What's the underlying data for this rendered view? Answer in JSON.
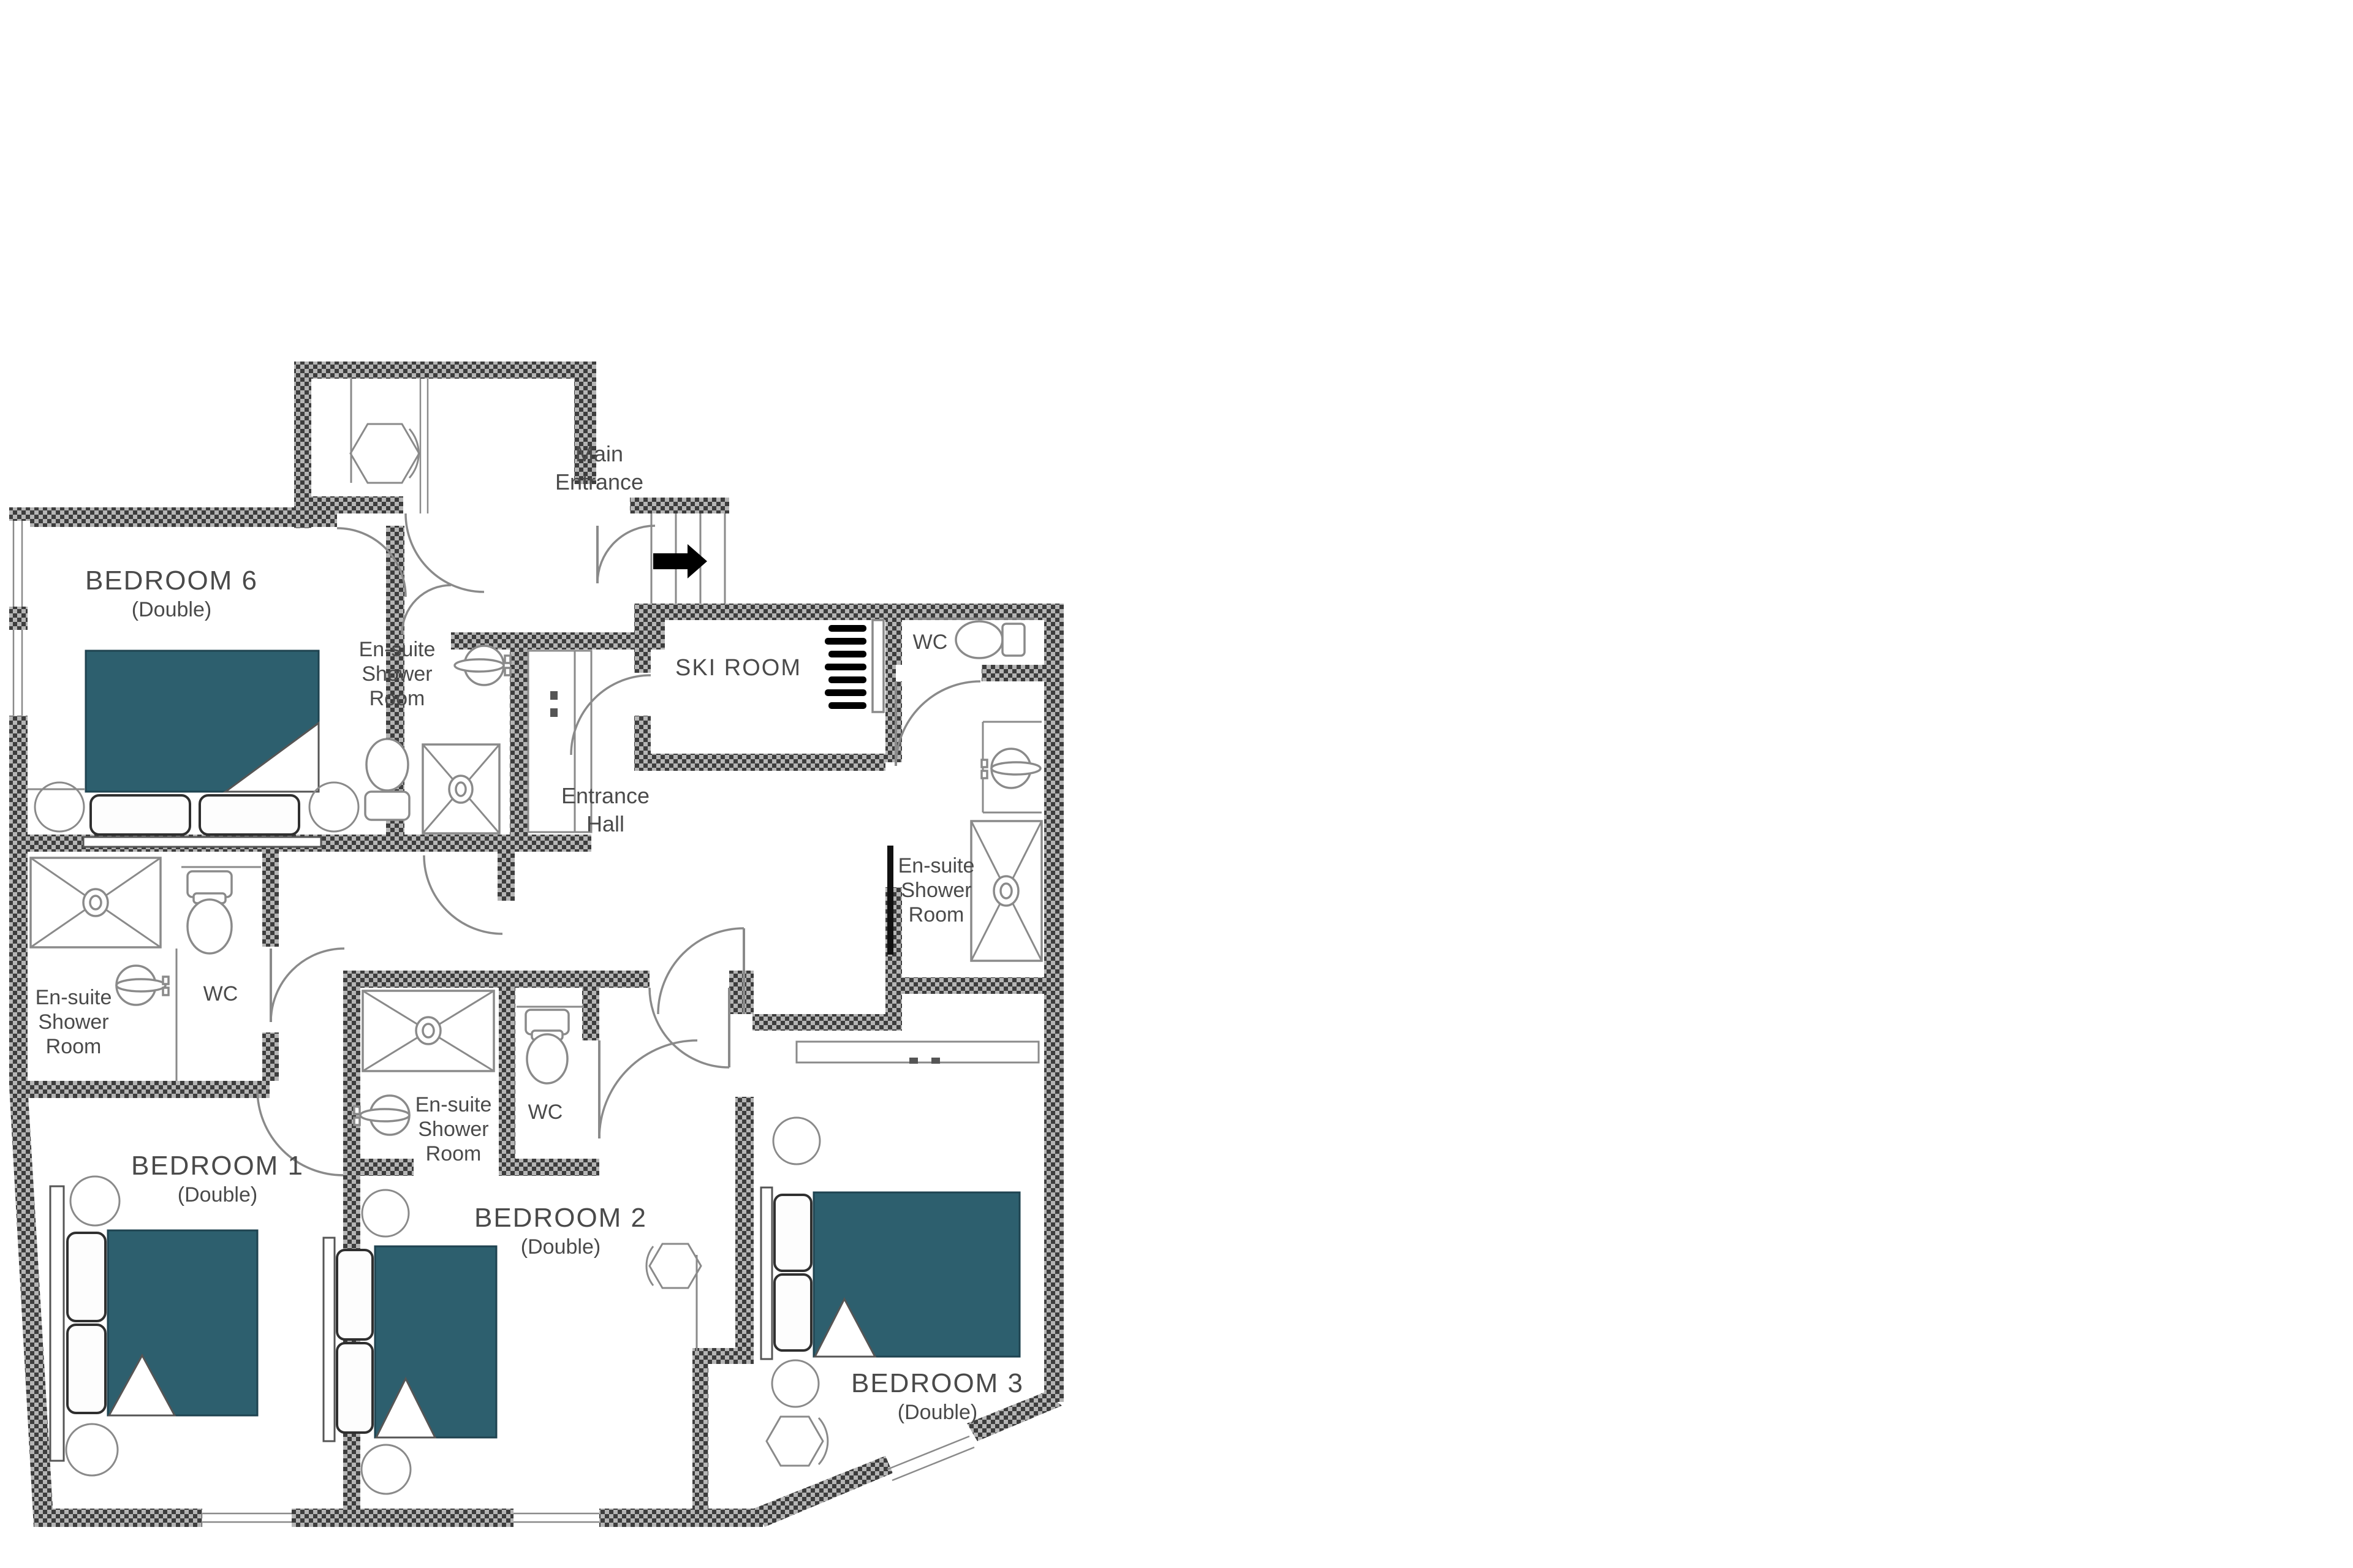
{
  "colors": {
    "bg": "#ffffff",
    "bed_fill": "#2d5f6e",
    "bed_edge": "#1f4350",
    "wall_dark": "#3d3d3d",
    "wall_light": "#b5b5b5",
    "line": "#8a8a8a",
    "dark_line": "#555555",
    "text": "#4a4a4a",
    "arrow": "#000000"
  },
  "rooms": [
    {
      "id": "main-entrance",
      "lines": [
        "Main",
        "Entrance"
      ]
    },
    {
      "id": "bedroom-6",
      "name": "BEDROOM 6",
      "sub": "(Double)"
    },
    {
      "id": "ensuite-top",
      "lines": [
        "En-suite",
        "Shower",
        "Room"
      ]
    },
    {
      "id": "ski-room",
      "lines": [
        "SKI ROOM"
      ]
    },
    {
      "id": "wc-top-right",
      "lines": [
        "WC"
      ]
    },
    {
      "id": "entrance-hall",
      "lines": [
        "Entrance",
        "Hall"
      ]
    },
    {
      "id": "ensuite-right",
      "lines": [
        "En-suite",
        "Shower",
        "Room"
      ]
    },
    {
      "id": "ensuite-left",
      "lines": [
        "En-suite",
        "Shower",
        "Room"
      ]
    },
    {
      "id": "wc-left",
      "lines": [
        "WC"
      ]
    },
    {
      "id": "bedroom-1",
      "name": "BEDROOM 1",
      "sub": "(Double)"
    },
    {
      "id": "ensuite-2",
      "lines": [
        "En-suite",
        "Shower",
        "Room"
      ]
    },
    {
      "id": "wc-2",
      "lines": [
        "WC"
      ]
    },
    {
      "id": "bedroom-2",
      "name": "BEDROOM 2",
      "sub": "(Double)"
    },
    {
      "id": "bedroom-3",
      "name": "BEDROOM 3",
      "sub": "(Double)"
    }
  ]
}
